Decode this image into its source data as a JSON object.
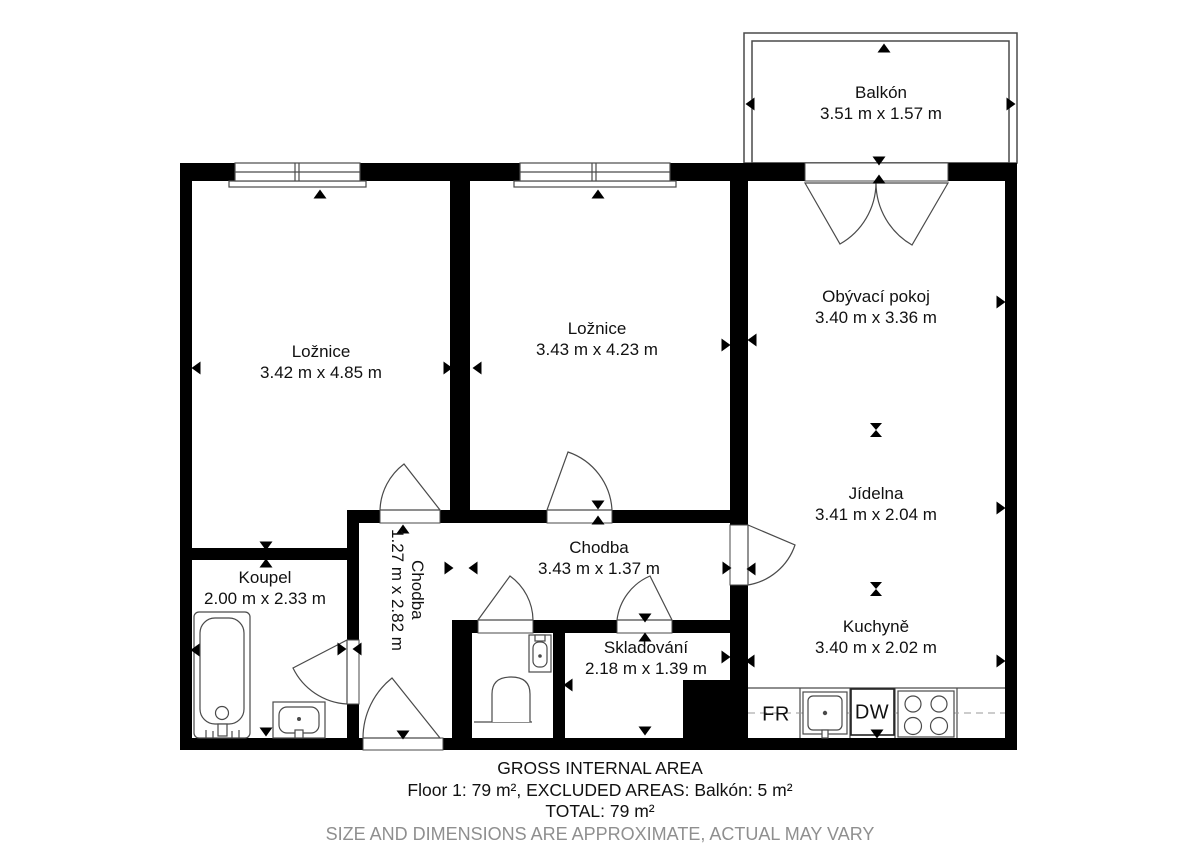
{
  "plan": {
    "rooms": {
      "balkon": {
        "name": "Balkón",
        "dims": "3.51 m x 1.57 m"
      },
      "loznice1": {
        "name": "Ložnice",
        "dims": "3.42 m x 4.85 m"
      },
      "loznice2": {
        "name": "Ložnice",
        "dims": "3.43 m x 4.23 m"
      },
      "obyvaci": {
        "name": "Obývací pokoj",
        "dims": "3.40 m x 3.36 m"
      },
      "jidelna": {
        "name": "Jídelna",
        "dims": "3.41 m x 2.04 m"
      },
      "kuchyne": {
        "name": "Kuchyně",
        "dims": "3.40 m x 2.02 m"
      },
      "chodba_v": {
        "name": "Chodba",
        "dims": "1.27 m x 2.82 m"
      },
      "chodba_h": {
        "name": "Chodba",
        "dims": "3.43 m x 1.37 m"
      },
      "koupel": {
        "name": "Koupel",
        "dims": "2.00 m x 2.33 m"
      },
      "skladovani": {
        "name": "Skladování",
        "dims": "2.18 m x 1.39 m"
      }
    },
    "appliances": {
      "fridge": "FR",
      "dishwasher": "DW"
    }
  },
  "footer": {
    "line1": "GROSS INTERNAL AREA",
    "line2": "Floor 1: 79 m², EXCLUDED AREAS: Balkón: 5 m²",
    "line3": "TOTAL: 79 m²",
    "line4": "SIZE AND DIMENSIONS ARE APPROXIMATE, ACTUAL MAY VARY"
  },
  "colors": {
    "wall": "#000000",
    "line": "#4a4a4a",
    "muted_text": "#8f8f8f"
  }
}
